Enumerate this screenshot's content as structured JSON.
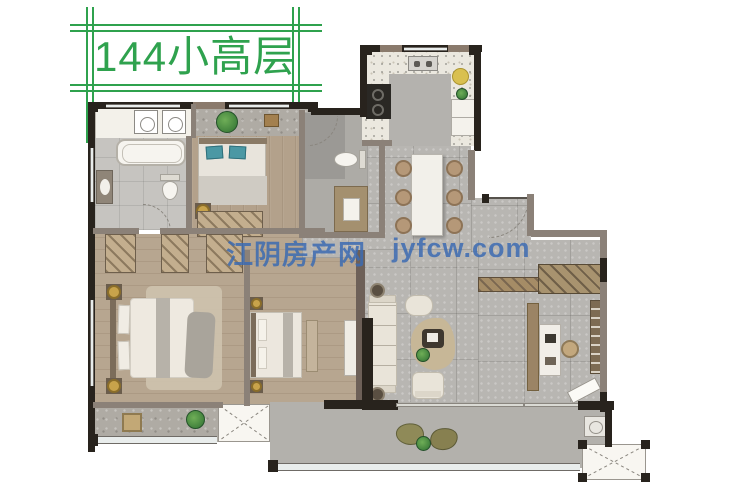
{
  "title": {
    "label": "144小高层"
  },
  "watermark": {
    "site_name": "江阴房产网",
    "site_url": "jyfcw.com"
  },
  "palette": {
    "accent_green": "#2fa24e",
    "watermark_blue": "#3c6bb2",
    "wall_black": "#28231d",
    "wall_gray": "#8b8178",
    "wood_floor": "#b3a18b",
    "tile_gray": "#b8b6b2",
    "kitchen_terrazzo": "#ebe8df",
    "pillow_teal": "#4b98a4",
    "lamp_gold": "#c8a34b",
    "window_glass": "#e9edec"
  }
}
